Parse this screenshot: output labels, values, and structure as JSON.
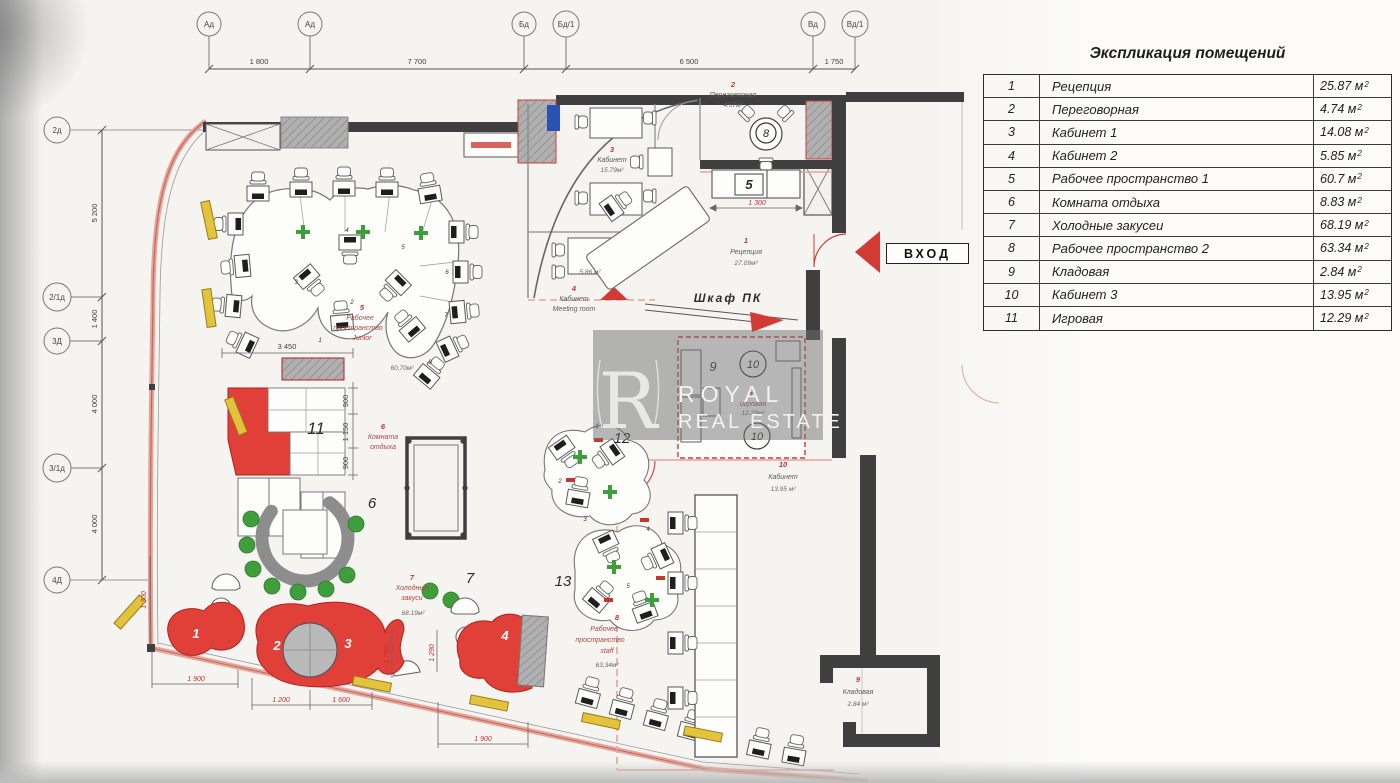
{
  "explication": {
    "title": "Экспликация помещений",
    "sup": "2",
    "rows": [
      {
        "num": "1",
        "name": "Рецепция",
        "area": "25.87 м"
      },
      {
        "num": "2",
        "name": "Переговорная",
        "area": "4.74 м"
      },
      {
        "num": "3",
        "name": "Кабинет 1",
        "area": "14.08 м"
      },
      {
        "num": "4",
        "name": "Кабинет 2",
        "area": "5.85 м"
      },
      {
        "num": "5",
        "name": "Рабочее пространство 1",
        "area": "60.7 м"
      },
      {
        "num": "6",
        "name": "Комната отдыха",
        "area": "8.83 м"
      },
      {
        "num": "7",
        "name": "Холодные закусеи",
        "area": "68.19 м"
      },
      {
        "num": "8",
        "name": "Рабочее пространство 2",
        "area": "63.34 м"
      },
      {
        "num": "9",
        "name": "Кладовая",
        "area": "2.84 м"
      },
      {
        "num": "10",
        "name": "Кабинет 3",
        "area": "13.95 м"
      },
      {
        "num": "11",
        "name": "Игровая",
        "area": "12.29 м"
      }
    ]
  },
  "axes": {
    "top": [
      "Ад",
      "Ад",
      "Бд",
      "Бд/1",
      "Вд",
      "Вд/1"
    ],
    "top_dims": [
      "1 800",
      "7 700",
      "6 500",
      "1 750"
    ],
    "left": [
      "2д",
      "2/1д",
      "3Д",
      "3/1д",
      "4Д"
    ],
    "left_dims": [
      "5 200",
      "1 400",
      "4 000",
      "4 000"
    ]
  },
  "plan": {
    "entrance": "ВХОД",
    "shkaf_pk": "Шкаф ПК",
    "watermark": {
      "logo": "R",
      "line1": "ROYAL",
      "line2": "REAL ESTATE"
    },
    "room_labels": {
      "reception": {
        "num": "1",
        "line1": "Рецепция",
        "area": "27.09м²"
      },
      "peregovornaya": {
        "num": "2",
        "line1": "Переговорная",
        "area": "4.57м²"
      },
      "kabinet3": {
        "num": "3",
        "line1": "Кабинет",
        "area": "15.79м²"
      },
      "kabinet4": {
        "num": "4",
        "line1": "Кабинет",
        "line2": "Meeting room",
        "area": "5.86 м²"
      },
      "junior": {
        "num": "5",
        "line1": "Рабочее",
        "line2": "пространство",
        "line3": "Junior",
        "area": "60,70м²"
      },
      "otdyha": {
        "num": "6",
        "line1": "Комната",
        "line2": "отдыха"
      },
      "zakuski": {
        "num": "7",
        "line1": "Холодные",
        "line2": "закуси",
        "area": "68.19м²"
      },
      "staff": {
        "num": "8",
        "line1": "Рабочее",
        "line2": "пространство",
        "line3": "staff",
        "area": "63,34м²"
      },
      "kladovaya": {
        "num": "9",
        "line1": "Кладовая",
        "area": "2.84 м²"
      },
      "kabinet10": {
        "num": "10",
        "line1": "Кабинет",
        "area": "13.95 м²"
      },
      "igrovaya": {
        "num": "11",
        "line1": "игровая",
        "area": "12.29м²"
      }
    },
    "furn": {
      "n5": "5",
      "n6": "6",
      "n7": "7",
      "n8": "8",
      "n9": "9",
      "n10": "10",
      "n11": "11",
      "n12": "12",
      "n13": "13",
      "w1": "1",
      "w2": "2",
      "w3": "3",
      "w4": "4"
    },
    "desk_left": [
      "1",
      "2",
      "3",
      "4",
      "5",
      "6",
      "7",
      "8"
    ],
    "desk_staff": [
      "1",
      "2",
      "3",
      "4",
      "5"
    ],
    "dims": {
      "d3450": "3 450",
      "v900a": "900",
      "v1150": "1 150",
      "v900b": "900",
      "r1900a": "1 900",
      "r1200": "1 200",
      "r1600": "1 600",
      "r1900b": "1 900",
      "r1300a": "1 300",
      "r1300b": "1 300",
      "v1780": "1 780",
      "v1290": "1 290"
    }
  },
  "colors": {
    "wall": "#3f3f3f",
    "red": "#d23b35",
    "salmon": "#e6a49a",
    "yellow": "#e3c23c",
    "green": "#3f9e3c",
    "blue": "#2a52b5",
    "gray_furniture": "#b5b5b5",
    "label_red": "#c9302c"
  }
}
